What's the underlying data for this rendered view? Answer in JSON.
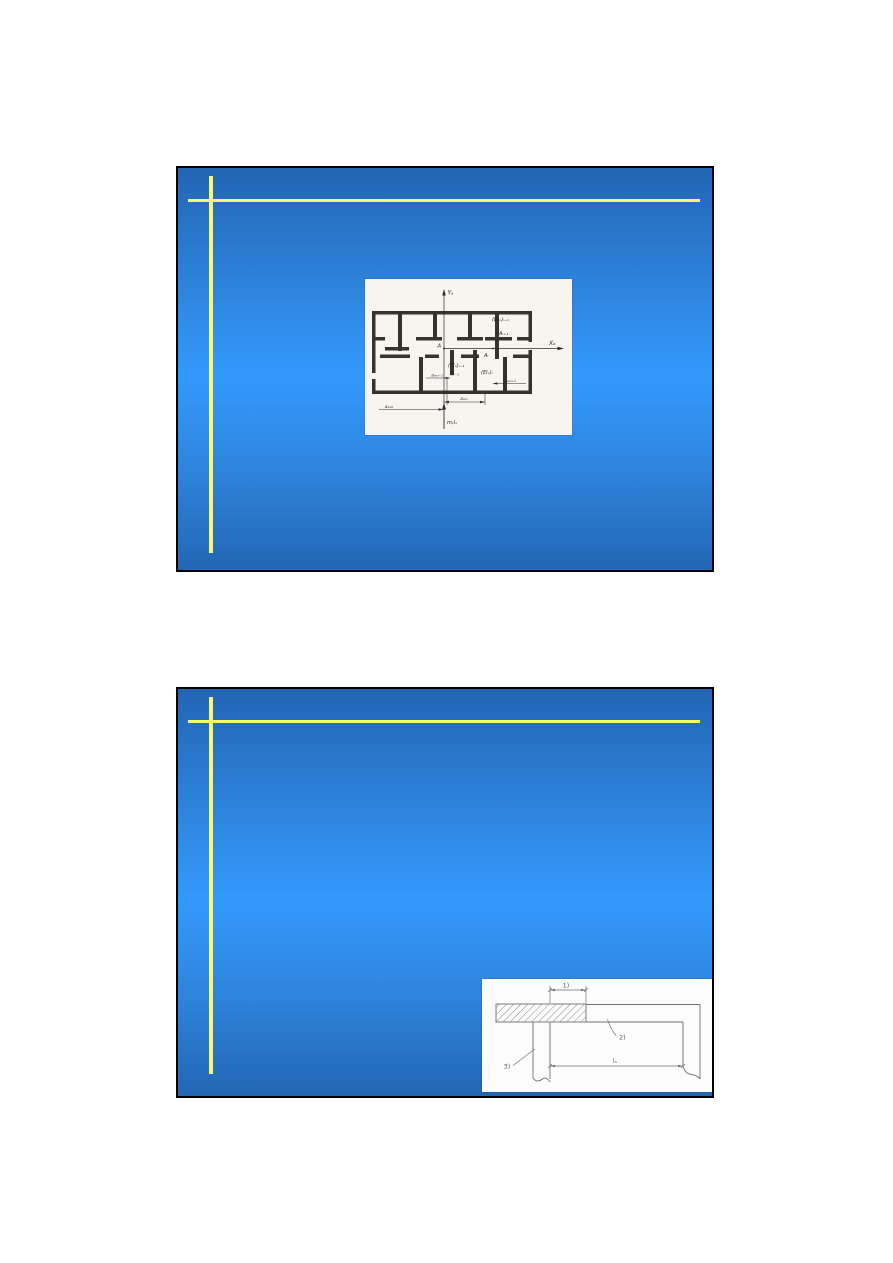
{
  "slides": {
    "slide1": {
      "figure": {
        "y_axis_label": "Yₐ",
        "x_axis_label": "Xₐ",
        "labels": {
          "ei_i_plus_1": "(EIₓ)ᵢ₊₁",
          "a_i_plus_1": "Aᵢ₊₁",
          "a_origin": "A",
          "a_i": "Aᵢ",
          "ei_i_minus_1": "(EIₓ)ᵢ₋₁",
          "a_i_minus_1": "Aᵢ₋₁",
          "ei_i": "(EIₓ)ᵢ",
          "dim_a_ax_i_minus_1": "aₐₓᵢ₋₁",
          "dim_a_ax_i_plus_1": "aₐₓᵢ₊₁",
          "dim_a_ax_i": "aₐₓᵢ",
          "dim_a_ax_0": "aₐₓ₀",
          "load_label": "mᵧlₓ"
        }
      }
    },
    "slide2": {
      "figure": {
        "labels": {
          "callout_1": "1)",
          "callout_2": "2)",
          "callout_3": "3)",
          "span_label": "lₛ"
        }
      }
    }
  },
  "theme": {
    "page_background": "#ffffff",
    "slide_gradient_top": "#2265b3",
    "slide_gradient_middle": "#3399fd",
    "slide_gradient_bottom": "#2366b4",
    "accent_line_color": "#f8f673",
    "slide_border_color": "#000000"
  }
}
